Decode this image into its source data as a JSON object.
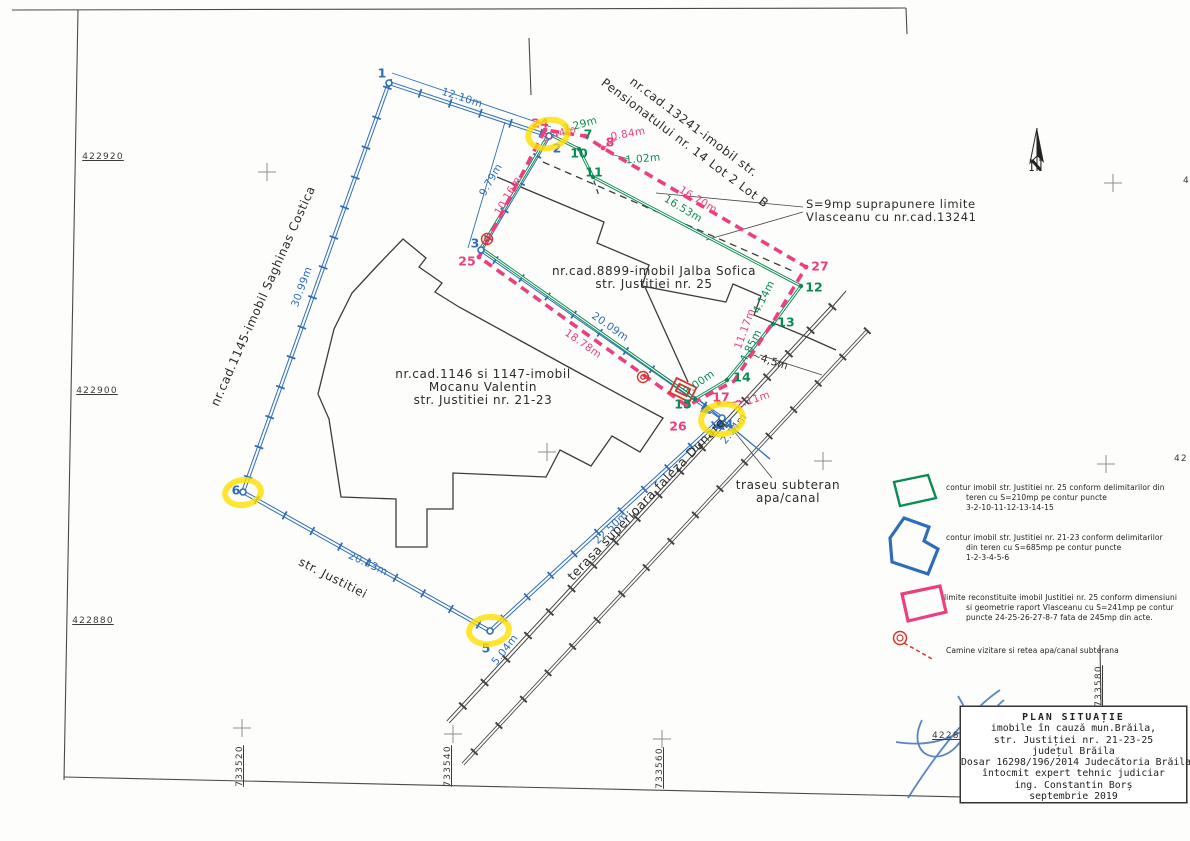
{
  "page": {
    "colors": {
      "blue": "#2f6db8",
      "green": "#0b8a52",
      "pink": "#ec3f80",
      "red": "#d6352c",
      "yellow": "#ffe000",
      "black": "#2b2b2b"
    },
    "north_label": "N",
    "grid_coords": [
      {
        "name": "coord-422920",
        "text": "422920",
        "x": 103,
        "y": 157,
        "rot": 0,
        "underline": true,
        "anchor": "center"
      },
      {
        "name": "coord-422900",
        "text": "422900",
        "x": 97,
        "y": 391,
        "rot": 0,
        "underline": true,
        "anchor": "center"
      },
      {
        "name": "coord-422880-left",
        "text": "422880",
        "x": 93,
        "y": 621,
        "rot": 0,
        "underline": true,
        "anchor": "center"
      },
      {
        "name": "coord-422880-right",
        "text": "422880",
        "x": 932,
        "y": 736,
        "rot": 0,
        "underline": true,
        "anchor": "left"
      },
      {
        "name": "coord-733520",
        "text": "733520",
        "x": 240,
        "y": 766,
        "rot": -90,
        "underline": true,
        "anchor": "center"
      },
      {
        "name": "coord-733540",
        "text": "733540",
        "x": 448,
        "y": 766,
        "rot": -90,
        "underline": true,
        "anchor": "center"
      },
      {
        "name": "coord-733560",
        "text": "733560",
        "x": 660,
        "y": 768,
        "rot": -90,
        "underline": true,
        "anchor": "center"
      },
      {
        "name": "coord-733580",
        "text": "733580",
        "x": 1099,
        "y": 686,
        "rot": -90,
        "underline": true,
        "anchor": "center"
      },
      {
        "name": "coord-edge-4",
        "text": "4",
        "x": 1183,
        "y": 181,
        "rot": 0,
        "underline": false,
        "anchor": "left"
      },
      {
        "name": "coord-edge-42",
        "text": "42",
        "x": 1174,
        "y": 459,
        "rot": 0,
        "underline": false,
        "anchor": "left"
      }
    ]
  },
  "map": {
    "area_labels": [
      {
        "name": "label-cad13241-line1",
        "text": "nr.cad.13241-imobil str.",
        "x": 694,
        "y": 127,
        "rot": 37,
        "color": "black",
        "size": 12
      },
      {
        "name": "label-cad13241-line2",
        "text": "Pensionatului nr. 14 Lot 2 Lot B",
        "x": 685,
        "y": 143,
        "rot": 37,
        "color": "black",
        "size": 12
      },
      {
        "name": "label-cad1145",
        "text": "nr.cad.1145-imobil Saghinas Costica",
        "x": 263,
        "y": 296,
        "rot": -66,
        "color": "black",
        "size": 12
      },
      {
        "name": "label-cad8899-line1",
        "text": "nr.cad.8899-imobil Jalba Sofica",
        "x": 654,
        "y": 271,
        "rot": 0,
        "color": "black",
        "size": 12
      },
      {
        "name": "label-cad8899-line2",
        "text": "str. Justitiei nr. 25",
        "x": 654,
        "y": 284,
        "rot": 0,
        "color": "black",
        "size": 12
      },
      {
        "name": "label-cad1146-line1",
        "text": "nr.cad.1146 si 1147-imobil",
        "x": 483,
        "y": 374,
        "rot": 0,
        "color": "black",
        "size": 12
      },
      {
        "name": "label-cad1146-line2",
        "text": "Mocanu Valentin",
        "x": 483,
        "y": 387,
        "rot": 0,
        "color": "black",
        "size": 12
      },
      {
        "name": "label-cad1146-line3",
        "text": "str. Justitiei nr. 21-23",
        "x": 483,
        "y": 400,
        "rot": 0,
        "color": "black",
        "size": 12
      },
      {
        "name": "label-overlap-line1",
        "text": "S=9mp suprapunere limite",
        "x": 806,
        "y": 204,
        "rot": 0,
        "color": "black",
        "size": 11.5,
        "anchor": "left"
      },
      {
        "name": "label-overlap-line2",
        "text": "Vlasceanu cu nr.cad.13241",
        "x": 806,
        "y": 217,
        "rot": 0,
        "color": "black",
        "size": 11.5,
        "anchor": "left"
      },
      {
        "name": "label-str-justitiei",
        "text": "str.  Justitiei",
        "x": 333,
        "y": 578,
        "rot": 27,
        "color": "black",
        "size": 12
      },
      {
        "name": "label-terasa",
        "text": "terasa superioara faleza Dunare",
        "x": 646,
        "y": 499,
        "rot": -46,
        "color": "black",
        "size": 12.5
      },
      {
        "name": "label-traseu-line1",
        "text": "traseu  subteran",
        "x": 788,
        "y": 485,
        "rot": 0,
        "color": "black",
        "size": 12
      },
      {
        "name": "label-traseu-line2",
        "text": "apa/canal",
        "x": 788,
        "y": 498,
        "rot": 0,
        "color": "black",
        "size": 12
      }
    ],
    "measurements": [
      {
        "name": "dim-12-10",
        "text": "12.10m",
        "x": 462,
        "y": 98,
        "rot": 18,
        "color": "blue"
      },
      {
        "name": "dim-9-79",
        "text": "9.79m",
        "x": 491,
        "y": 180,
        "rot": -60,
        "color": "blue"
      },
      {
        "name": "dim-10-16",
        "text": "10.16m",
        "x": 508,
        "y": 196,
        "rot": -60,
        "color": "pink"
      },
      {
        "name": "dim-20-09",
        "text": "20.09m",
        "x": 610,
        "y": 327,
        "rot": 35,
        "color": "blue"
      },
      {
        "name": "dim-18-78",
        "text": "18.78m",
        "x": 583,
        "y": 344,
        "rot": 35,
        "color": "pink"
      },
      {
        "name": "dim-22-50",
        "text": "22.50m",
        "x": 611,
        "y": 528,
        "rot": -43,
        "color": "blue"
      },
      {
        "name": "dim-20-43",
        "text": "20.43m",
        "x": 368,
        "y": 564,
        "rot": 25,
        "color": "blue"
      },
      {
        "name": "dim-30-99",
        "text": "30.99m",
        "x": 302,
        "y": 287,
        "rot": -70,
        "color": "blue"
      },
      {
        "name": "dim-5-04",
        "text": "5.04m",
        "x": 505,
        "y": 650,
        "rot": -52,
        "color": "blue"
      },
      {
        "name": "dim-2-14",
        "text": "2.14m",
        "x": 734,
        "y": 429,
        "rot": -52,
        "color": "blue"
      },
      {
        "name": "dim-3-29",
        "text": "3.29m",
        "x": 580,
        "y": 125,
        "rot": -16,
        "color": "green"
      },
      {
        "name": "dim-3-44",
        "text": "3.44m",
        "x": 559,
        "y": 134,
        "rot": -16,
        "color": "pink"
      },
      {
        "name": "dim-0-84",
        "text": "0.84m",
        "x": 628,
        "y": 134,
        "rot": -10,
        "color": "pink"
      },
      {
        "name": "dim-1-02",
        "text": "1.02m",
        "x": 643,
        "y": 159,
        "rot": -5,
        "color": "green"
      },
      {
        "name": "dim-16-70",
        "text": "16.70m",
        "x": 698,
        "y": 200,
        "rot": 31,
        "color": "pink"
      },
      {
        "name": "dim-16-53",
        "text": "16.53m",
        "x": 683,
        "y": 209,
        "rot": 31,
        "color": "green"
      },
      {
        "name": "dim-4-14",
        "text": "4.14m",
        "x": 764,
        "y": 297,
        "rot": -63,
        "color": "green"
      },
      {
        "name": "dim-11-17",
        "text": "11.17m",
        "x": 745,
        "y": 329,
        "rot": -70,
        "color": "pink"
      },
      {
        "name": "dim-4-85",
        "text": "4.85m",
        "x": 751,
        "y": 346,
        "rot": -63,
        "color": "green"
      },
      {
        "name": "dim-4-5",
        "text": "~4,5m",
        "x": 770,
        "y": 361,
        "rot": 18,
        "color": "black"
      },
      {
        "name": "dim-3-00",
        "text": "3.00m",
        "x": 699,
        "y": 383,
        "rot": -35,
        "color": "green"
      },
      {
        "name": "dim-2-11",
        "text": "2.11m",
        "x": 753,
        "y": 400,
        "rot": -18,
        "color": "pink"
      }
    ],
    "points": [
      {
        "name": "point-1",
        "text": "1",
        "x": 382,
        "y": 73,
        "color": "blue"
      },
      {
        "name": "point-2",
        "text": "2",
        "x": 557,
        "y": 148,
        "color": "blue"
      },
      {
        "name": "point-3",
        "text": "3",
        "x": 475,
        "y": 243,
        "color": "blue"
      },
      {
        "name": "point-4",
        "text": "4",
        "x": 729,
        "y": 424,
        "color": "blue"
      },
      {
        "name": "point-5",
        "text": "5",
        "x": 486,
        "y": 648,
        "color": "blue"
      },
      {
        "name": "point-6",
        "text": "6",
        "x": 236,
        "y": 490,
        "color": "blue"
      },
      {
        "name": "point-7",
        "text": "7",
        "x": 588,
        "y": 134,
        "color": "green"
      },
      {
        "name": "point-10",
        "text": "10",
        "x": 579,
        "y": 153,
        "color": "green"
      },
      {
        "name": "point-11",
        "text": "11",
        "x": 594,
        "y": 172,
        "color": "green"
      },
      {
        "name": "point-12",
        "text": "12",
        "x": 814,
        "y": 287,
        "color": "green"
      },
      {
        "name": "point-13",
        "text": "13",
        "x": 786,
        "y": 322,
        "color": "green"
      },
      {
        "name": "point-14",
        "text": "14",
        "x": 742,
        "y": 377,
        "color": "green"
      },
      {
        "name": "point-15",
        "text": "15",
        "x": 683,
        "y": 404,
        "color": "green"
      },
      {
        "name": "point-8",
        "text": "8",
        "x": 610,
        "y": 142,
        "color": "pink"
      },
      {
        "name": "point-17",
        "text": "17",
        "x": 721,
        "y": 397,
        "color": "pink"
      },
      {
        "name": "point-24",
        "text": "24",
        "x": 540,
        "y": 123,
        "color": "pink"
      },
      {
        "name": "point-25",
        "text": "25",
        "x": 467,
        "y": 261,
        "color": "pink"
      },
      {
        "name": "point-26",
        "text": "26",
        "x": 678,
        "y": 426,
        "color": "pink"
      },
      {
        "name": "point-27",
        "text": "27",
        "x": 820,
        "y": 266,
        "color": "pink"
      }
    ]
  },
  "legend": {
    "items": [
      {
        "color": "green",
        "lines": [
          "contur imobil str. Justitiei nr. 25 conform delimitarilor din",
          "teren cu S=210mp pe contur puncte",
          "3-2-10-11-12-13-14-15"
        ]
      },
      {
        "color": "blue",
        "lines": [
          "contur imobil str. Justitiei nr. 21-23 conform delimitarilor",
          "din teren cu S=685mp pe contur puncte",
          "1-2-3-4-5-6"
        ]
      },
      {
        "color": "pink",
        "lines": [
          "limite reconstituite imobil Justitiei nr. 25 conform dimensiuni",
          "si geometrie raport Vlasceanu cu S=241mp pe contur",
          "puncte 24-25-26-27-8-7 fata de 245mp din acte."
        ]
      },
      {
        "color": "red",
        "lines": [
          "Camine vizitare si retea apa/canal subterana"
        ]
      }
    ]
  },
  "title_block": {
    "lines": [
      "PLAN SITUAȚIE",
      "imobile în cauză mun.Brăila,",
      "str. Justiției nr. 21-23-25",
      "județul Brăila",
      "Dosar 16298/196/2014 Judecătoria Brăila",
      "întocmit expert tehnic judiciar",
      "ing. Constantin Borș",
      "septembrie 2019"
    ]
  }
}
